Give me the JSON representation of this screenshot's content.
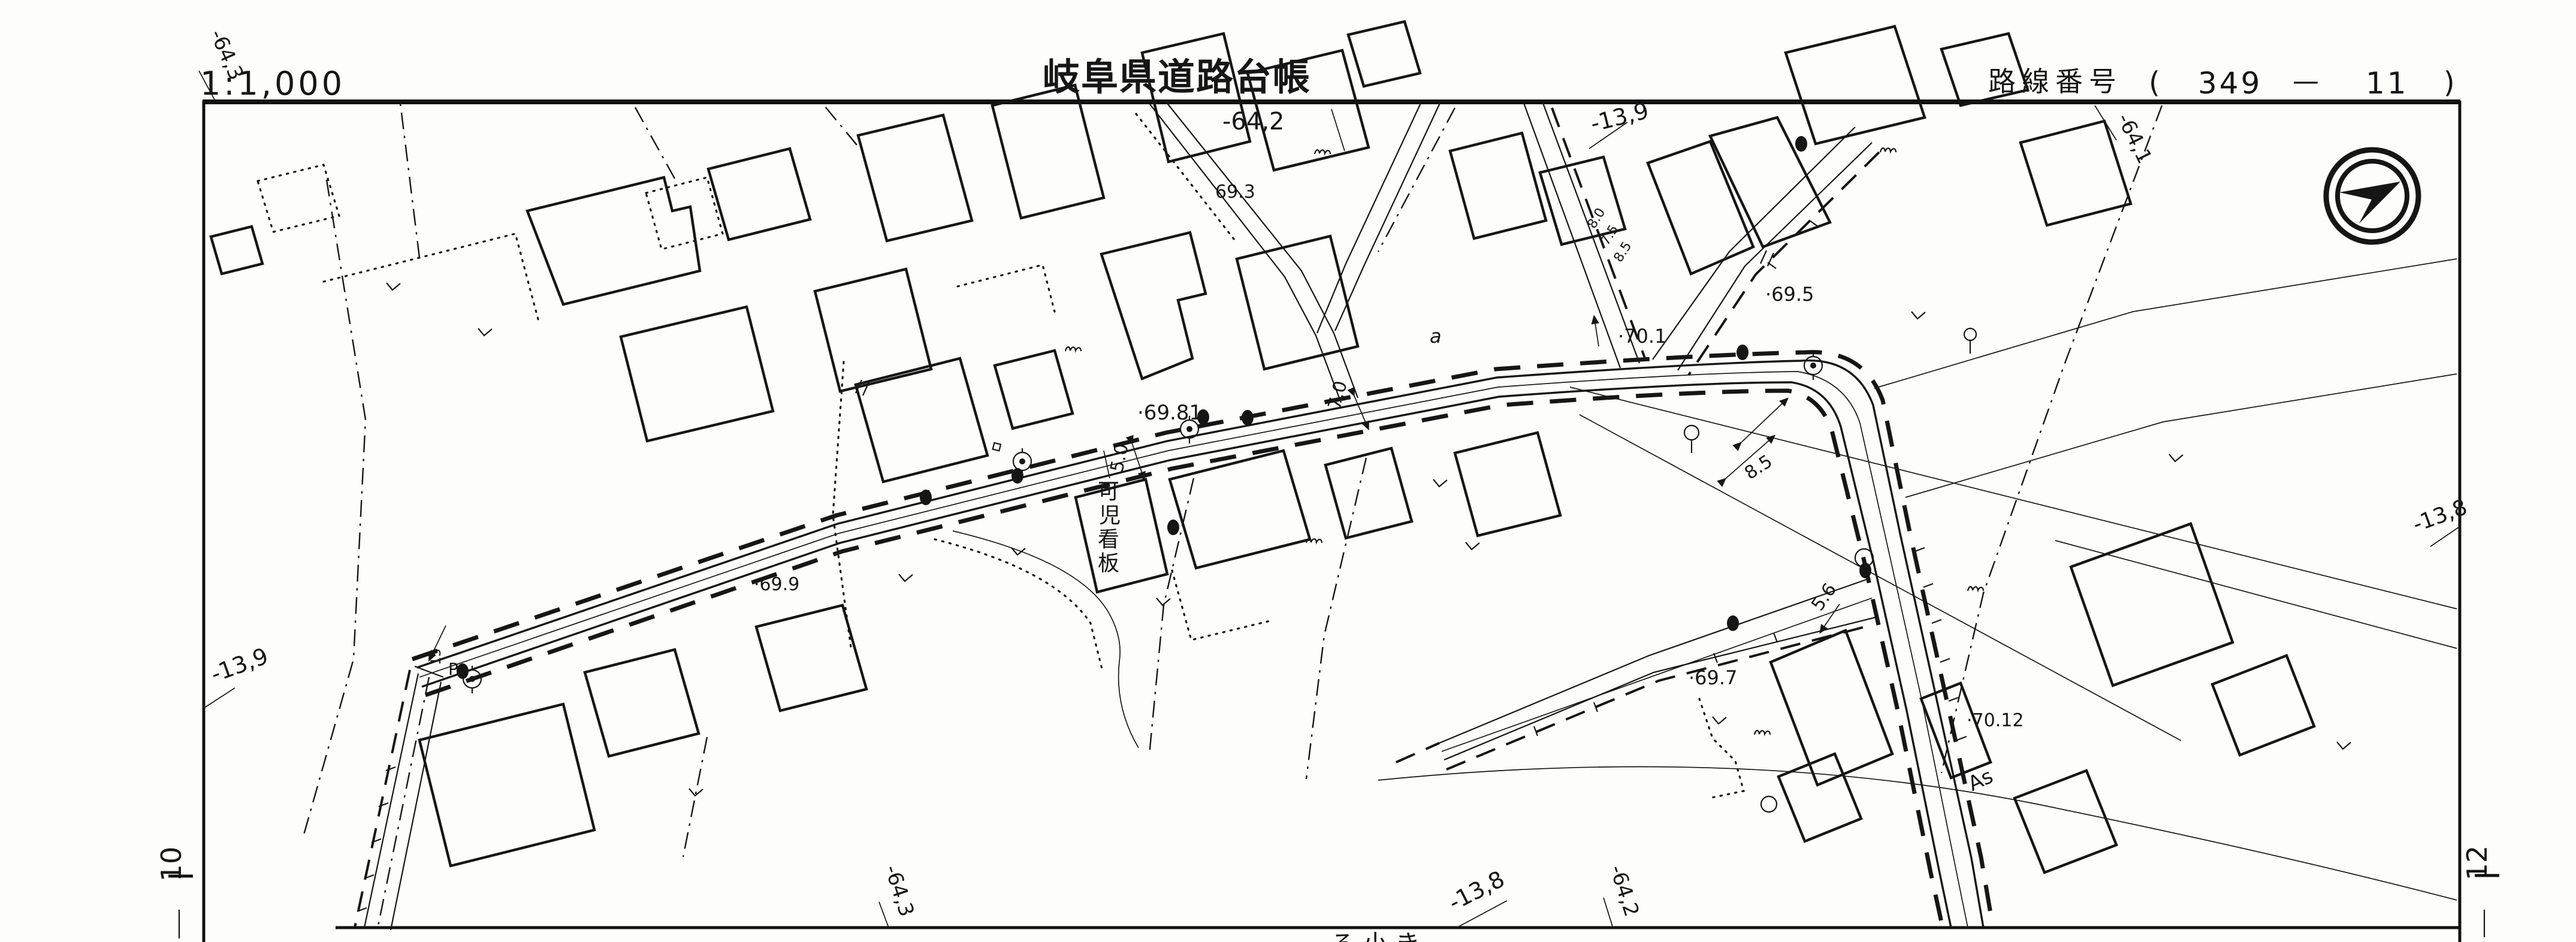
{
  "header": {
    "scale": "1:1,000",
    "title": "岐阜県道路台帳",
    "route_label": "路線番号",
    "route_open": "(",
    "route_number": "349",
    "route_dash": "—",
    "route_branch": "11",
    "route_close": ")"
  },
  "grid_labels": {
    "top_left": "-64,3",
    "top_center": "-64,2",
    "top_center_right": "-13,9",
    "top_right": "-64,1",
    "left_mid": "-13,9",
    "right_mid": "-13,8",
    "bottom_left": "-64,3",
    "bottom_center": "-13,8",
    "bottom_right": "-64,2",
    "sheet_left": "10",
    "sheet_right": "12"
  },
  "map_labels": {
    "signboard": [
      "可",
      "児",
      "看",
      "板"
    ],
    "elev_69_3": "69.3",
    "elev_69_5": "·69.5",
    "elev_69_7": "·69.7",
    "elev_69_81": "·69.81",
    "elev_69_9": "·69.9",
    "elev_70_1": "·70.1",
    "elev_70_12": "·70.12",
    "width_7_0": "7.0",
    "width_5_0": "5.0",
    "width_8_5": "8.5",
    "width_5_6": "5.6",
    "width_small_1": "8.0",
    "width_small_2": "7.5",
    "width_small_3": "8.5",
    "point_a": "a",
    "surface_as": "As",
    "station_p": "P",
    "station_15": "15",
    "clipped_bottom": "ろ小き"
  }
}
